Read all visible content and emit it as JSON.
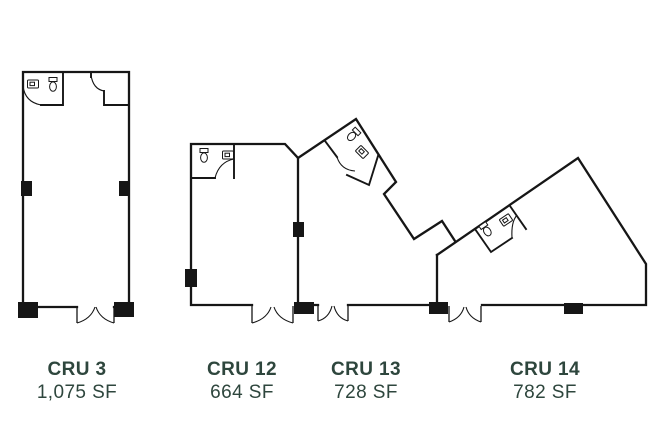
{
  "colors": {
    "background": "#ffffff",
    "wall": "#161616",
    "label_text": "#2e463d"
  },
  "units": [
    {
      "name": "CRU 3",
      "area": "1,075 SF",
      "fixtures": [
        "toilet",
        "sink"
      ],
      "entrance": "double-door"
    },
    {
      "name": "CRU 12",
      "area": "664 SF",
      "fixtures": [
        "toilet",
        "sink"
      ],
      "entrance": "double-door"
    },
    {
      "name": "CRU 13",
      "area": "728 SF",
      "fixtures": [
        "toilet",
        "sink"
      ],
      "entrance": "double-door"
    },
    {
      "name": "CRU 14",
      "area": "782 SF",
      "fixtures": [
        "toilet",
        "sink"
      ],
      "entrance": "double-door"
    }
  ]
}
